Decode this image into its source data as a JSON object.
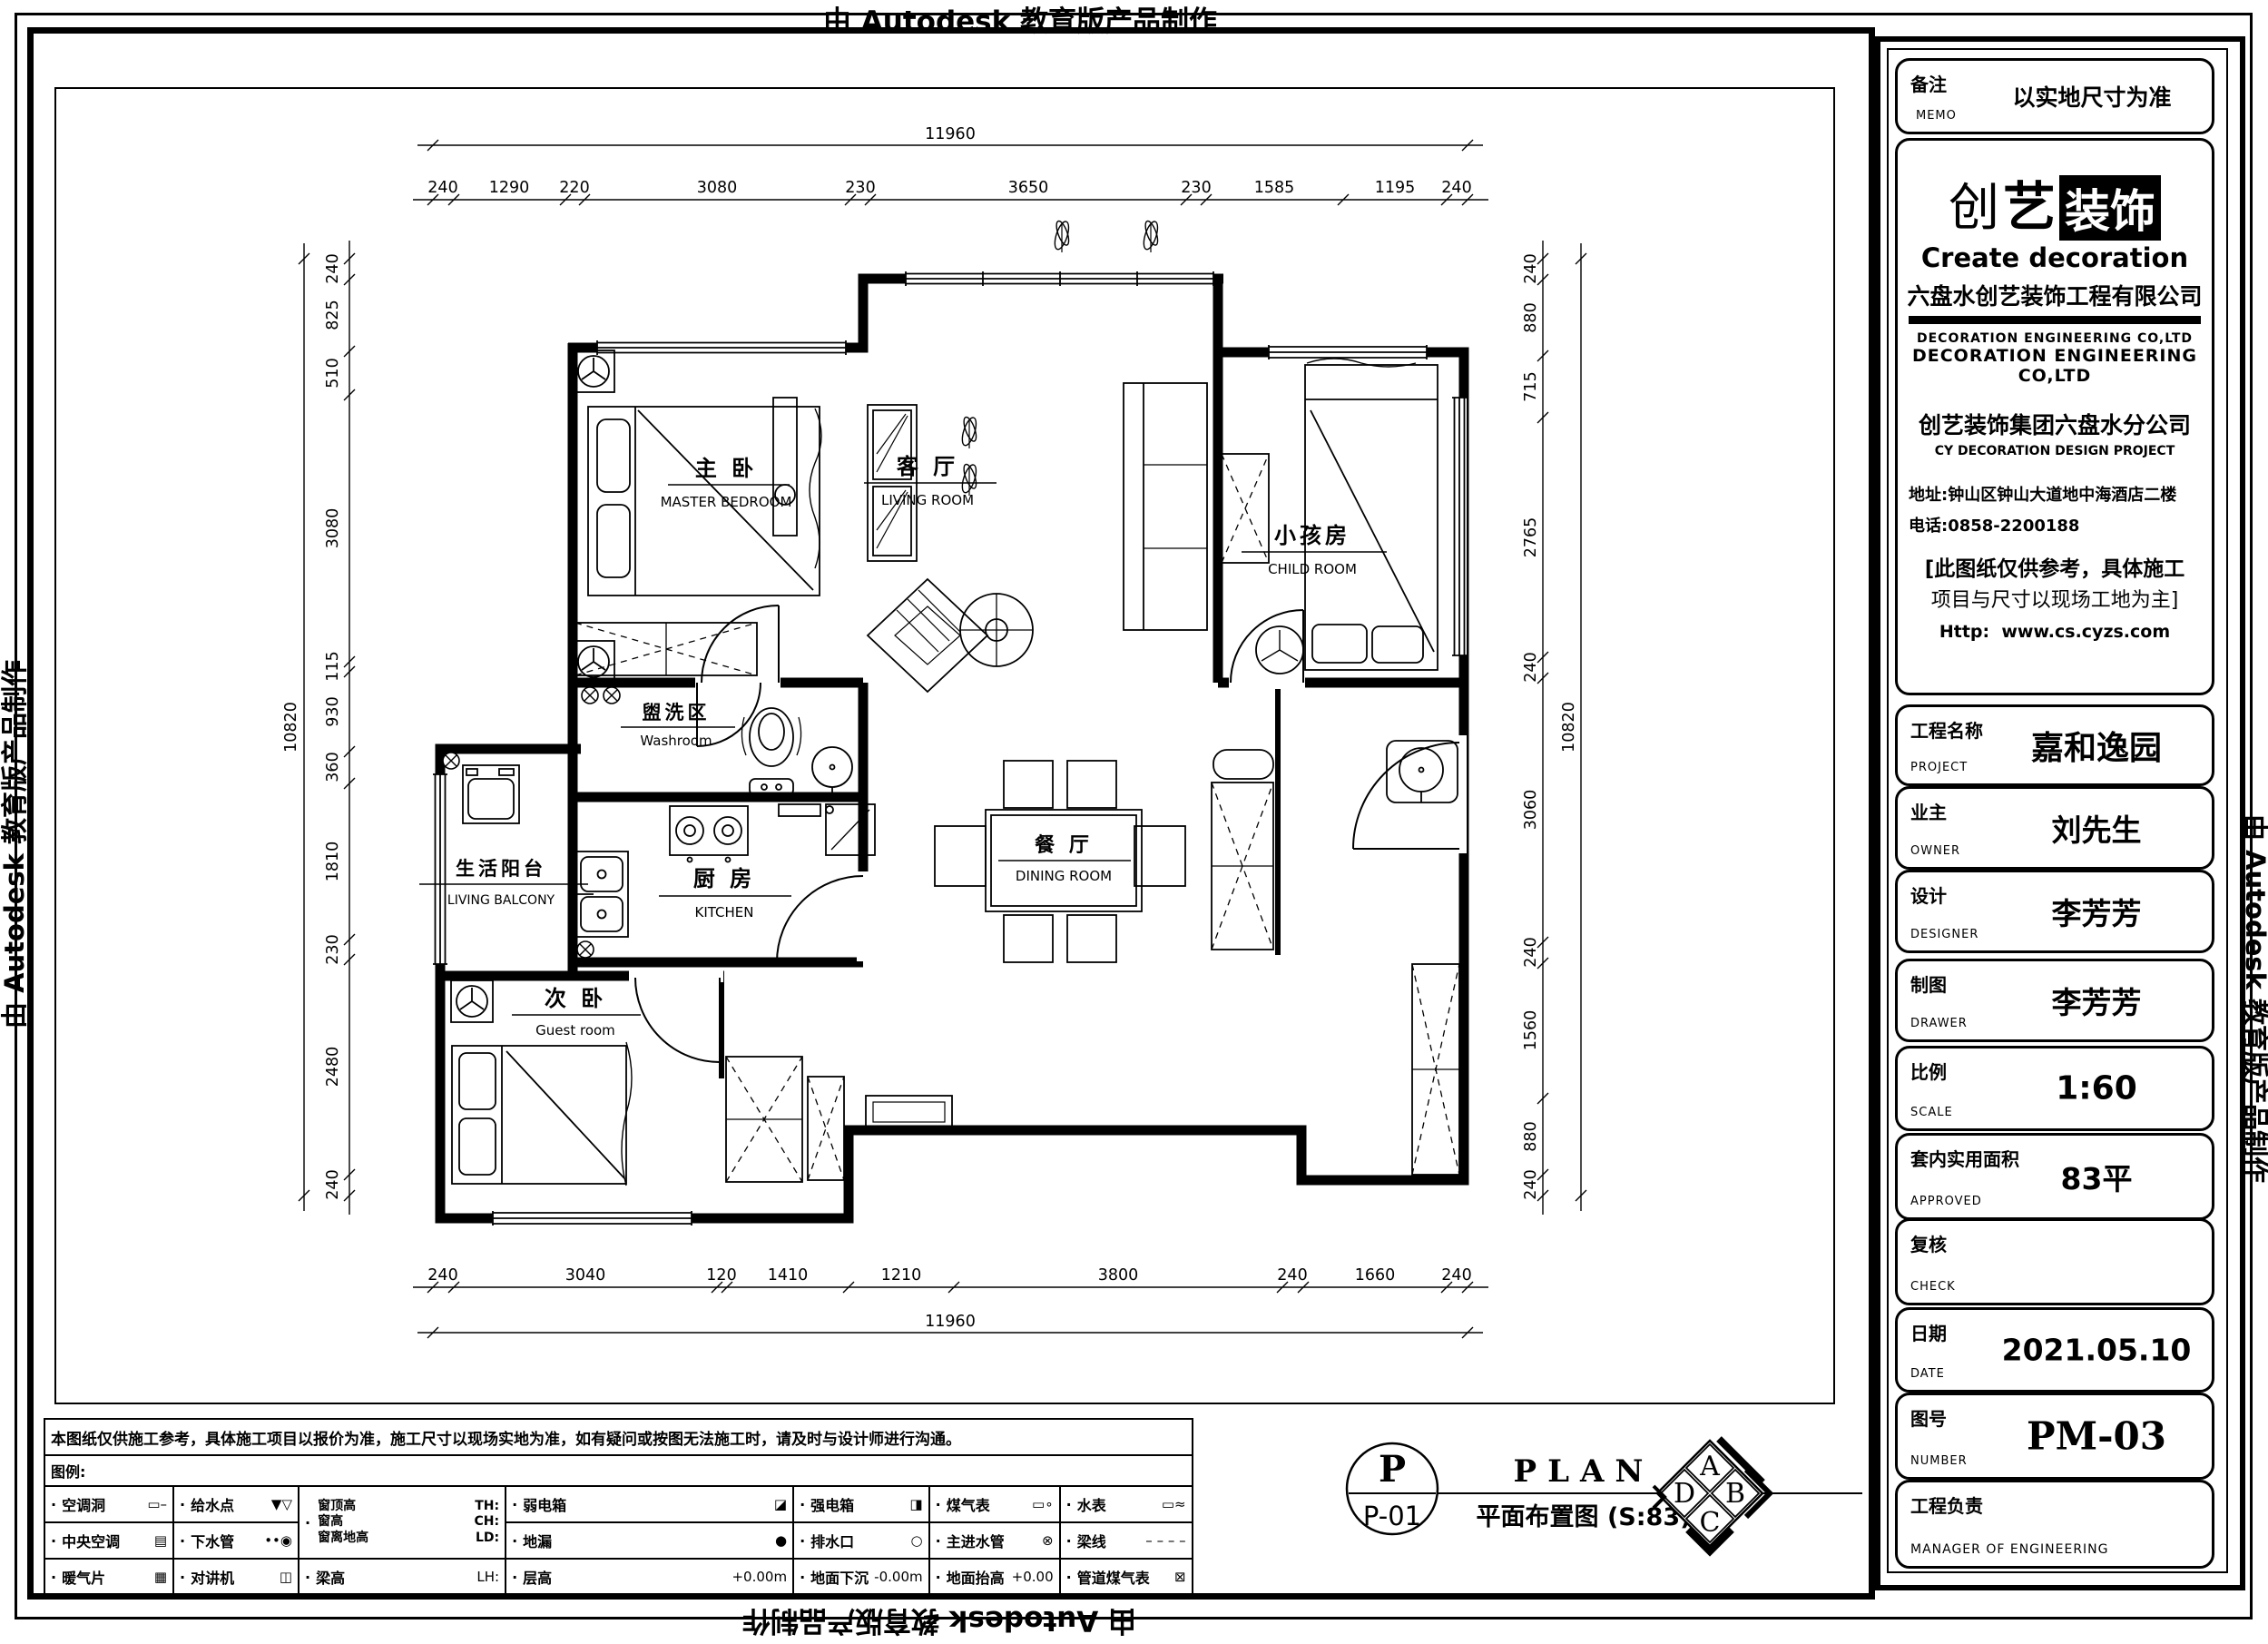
{
  "stamp": "由 Autodesk 教育版产品制作",
  "plan": {
    "rooms": {
      "master": {
        "zh": "主 卧",
        "en": "MASTER BEDROOM"
      },
      "living": {
        "zh": "客 厅",
        "en": "LIVING ROOM"
      },
      "child": {
        "zh": "小孩房",
        "en": "CHILD ROOM"
      },
      "washroom": {
        "zh": "盥洗区",
        "en": "Washroom"
      },
      "balcony": {
        "zh": "生活阳台",
        "en": "LIVING BALCONY"
      },
      "kitchen": {
        "zh": "厨 房",
        "en": "KITCHEN"
      },
      "guest": {
        "zh": "次 卧",
        "en": "Guest room"
      },
      "dining": {
        "zh": "餐 厅",
        "en": "DINING ROOM"
      }
    },
    "dims": {
      "top": {
        "total": "11960",
        "segments": [
          "240",
          "1290",
          "220",
          "3080",
          "230",
          "3650",
          "230",
          "1585",
          "1195",
          "240"
        ]
      },
      "bottom": {
        "total": "11960",
        "segments": [
          "240",
          "3040",
          "120",
          "1410",
          "1210",
          "3800",
          "240",
          "1660",
          "240"
        ]
      },
      "left": {
        "total": "10820",
        "segments": [
          "240",
          "825",
          "510",
          "3080",
          "115",
          "930",
          "360",
          "1810",
          "230",
          "2480",
          "240"
        ]
      },
      "right": {
        "total": "10820",
        "segments": [
          "240",
          "880",
          "715",
          "2765",
          "240",
          "3060",
          "240",
          "1560",
          "880",
          "240"
        ]
      }
    },
    "title": {
      "tag": "P",
      "tag_no": "P-01",
      "en": "PLAN",
      "zh": "平面布置图 (S:83)"
    },
    "compass": {
      "a": "A",
      "b": "B",
      "c": "C",
      "d": "D"
    }
  },
  "legend": {
    "note": "本图纸仅供施工参考，具体施工项目以报价为准，施工尺寸以现场实地为准，如有疑问或按图无法施工时，请及时与设计师进行沟通。",
    "label": "图例:",
    "bullet": "·",
    "window": {
      "l1": {
        "zh": "窗顶高",
        "code": "TH:"
      },
      "l2": {
        "zh": "窗高",
        "code": "CH:"
      },
      "l3": {
        "zh": "窗离地高",
        "code": "LD:"
      }
    },
    "items": {
      "ac_hole": {
        "label": "空调洞",
        "sym": "▭–"
      },
      "water_supply": {
        "label": "给水点",
        "sym": "▼▽"
      },
      "weak_box": {
        "label": "弱电箱",
        "sym": "◪"
      },
      "strong_box": {
        "label": "强电箱",
        "sym": "◨"
      },
      "gas_meter": {
        "label": "煤气表",
        "sym": "▭∘"
      },
      "water_meter": {
        "label": "水表",
        "sym": "▭≈"
      },
      "central_ac": {
        "label": "中央空调",
        "sym": "▤"
      },
      "sewer_pipe": {
        "label": "下水管",
        "sym": "••◉"
      },
      "floor_drain": {
        "label": "地漏",
        "sym": "●"
      },
      "drain_outlet": {
        "label": "排水口",
        "sym": "○"
      },
      "main_water": {
        "label": "主进水管",
        "sym": "⊗"
      },
      "beam_line": {
        "label": "梁线",
        "sym": "– – – –"
      },
      "radiator": {
        "label": "暖气片",
        "sym": "▦"
      },
      "intercom": {
        "label": "对讲机",
        "sym": "◫"
      },
      "beam_height": {
        "label": "梁高",
        "code": "LH:"
      },
      "floor_height": {
        "label": "层高",
        "sym": "+0.00m"
      },
      "floor_sunken": {
        "label": "地面下沉",
        "sym": "-0.00m"
      },
      "floor_raised": {
        "label": "地面抬高",
        "sym": "+0.00"
      },
      "pipe_gas": {
        "label": "管道煤气表",
        "sym": "⊠"
      }
    }
  },
  "titleblock": {
    "memo": {
      "zh": "备注",
      "en": "MEMO",
      "value": "以实地尺寸为准"
    },
    "company": {
      "logo_l": "创",
      "logo_m": "艺",
      "logo_r": "装饰",
      "logo_en": "Create decoration",
      "name_zh": "六盘水创艺装饰工程有限公司",
      "deco_light": "DECORATION  ENGINEERING  CO,LTD",
      "deco_bold": "DECORATION  ENGINEERING  CO,LTD",
      "branch_zh": "创艺装饰集团六盘水分公司",
      "branch_en": "CY DECORATION DESIGN PROJECT",
      "address": "地址:钟山区钟山大道地中海酒店二楼",
      "phone": "电话:0858-2200188",
      "note1": "[此图纸仅供参考，具体施工",
      "note2": "项目与尺寸以现场工地为主]",
      "web_label": "Http:",
      "web_url": "www.cs.cyzs.com"
    },
    "fields": {
      "project": {
        "zh": "工程名称",
        "en": "PROJECT",
        "value": "嘉和逸园"
      },
      "owner": {
        "zh": "业主",
        "en": "OWNER",
        "value": "刘先生"
      },
      "designer": {
        "zh": "设计",
        "en": "DESIGNER",
        "value": "李芳芳"
      },
      "drawer": {
        "zh": "制图",
        "en": "DRAWER",
        "value": "李芳芳"
      },
      "scale": {
        "zh": "比例",
        "en": "SCALE",
        "value": "1:60"
      },
      "approved": {
        "zh": "套内实用面积",
        "en": "APPROVED",
        "value": "83平"
      },
      "check": {
        "zh": "复核",
        "en": "CHECK",
        "value": ""
      },
      "date": {
        "zh": "日期",
        "en": "DATE",
        "value": "2021.05.10"
      },
      "number": {
        "zh": "图号",
        "en": "NUMBER",
        "value": "PM-03"
      },
      "manager": {
        "zh": "工程负责",
        "en": "MANAGER OF ENGINEERING",
        "value": ""
      }
    }
  }
}
